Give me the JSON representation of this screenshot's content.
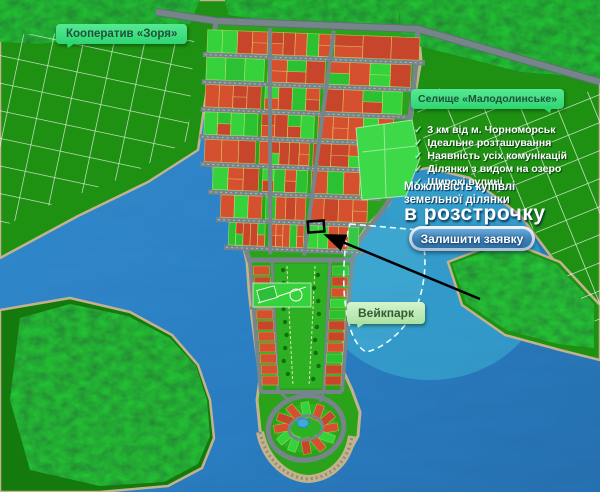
{
  "labels": {
    "cooperative": "Кооператив «Зоря»",
    "village": "Селище «Малодолинське»",
    "wakepark": "Вейкпарк"
  },
  "checklist": {
    "check_glyph": "✓",
    "items": [
      "3 км від м. Чорноморськ",
      "Ідеальне розташування",
      "Наявність усіх комунікацій",
      "Ділянки з видом на озеро",
      "Широкі вулиці"
    ]
  },
  "offer": {
    "line1": "Можливість купівлі",
    "line2": "земельної ділянки",
    "highlight": "в розстрочку",
    "cta_label": "Залишити заявку"
  },
  "map": {
    "colors": {
      "water": "#2176c0",
      "lake_teal": "#35b8d4",
      "land": "#1e9012",
      "peninsula": "#2aa31b",
      "forest": "#0d6b08",
      "road": "#75858a",
      "shore": "#c3b28e",
      "plot_taken": "#d5502e",
      "plot_taken_alt": "#c7452a",
      "plot_available": "#35d23c",
      "plot_available_alt": "#2bc133",
      "meadow": "#3ed948",
      "label_green": "#2ed573",
      "cta_blue": "#3c7fb5"
    }
  }
}
